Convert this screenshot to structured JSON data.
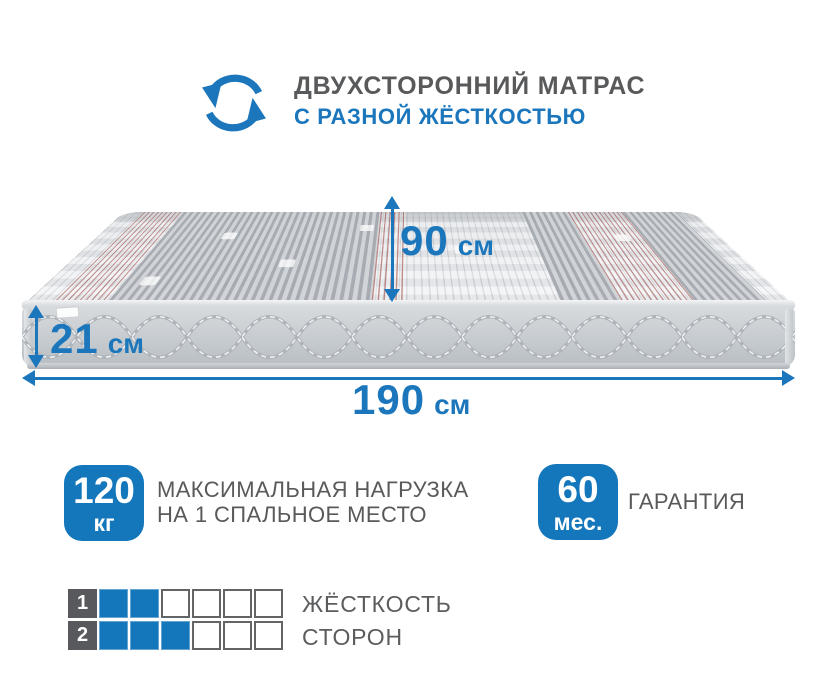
{
  "colors": {
    "accent_blue": "#1b76bc",
    "badge_blue": "#1476bb",
    "text_gray": "#58595b",
    "index_cell_dark": "#58595c"
  },
  "header": {
    "icon": "rotate-arrows-icon",
    "title_line1": "ДВУХСТОРОННИЙ МАТРАС",
    "title_line2": "С РАЗНОЙ ЖЁСТКОСТЬЮ"
  },
  "dimensions": {
    "depth": {
      "value": "90",
      "unit": "см"
    },
    "height": {
      "value": "21",
      "unit": "см"
    },
    "length": {
      "value": "190",
      "unit": "см"
    }
  },
  "features": {
    "max_load": {
      "value": "120",
      "unit": "кг",
      "label_line1": "МАКСИМАЛЬНАЯ НАГРУЗКА",
      "label_line2": "НА 1 СПАЛЬНОЕ МЕСТО"
    },
    "warranty": {
      "value": "60",
      "unit": "мес.",
      "label": "ГАРАНТИЯ"
    }
  },
  "firmness": {
    "rows": [
      {
        "index": "1",
        "filled": 2,
        "total": 6
      },
      {
        "index": "2",
        "filled": 3,
        "total": 6
      }
    ],
    "label_line1": "ЖЁСТКОСТЬ",
    "label_line2": "СТОРОН"
  }
}
